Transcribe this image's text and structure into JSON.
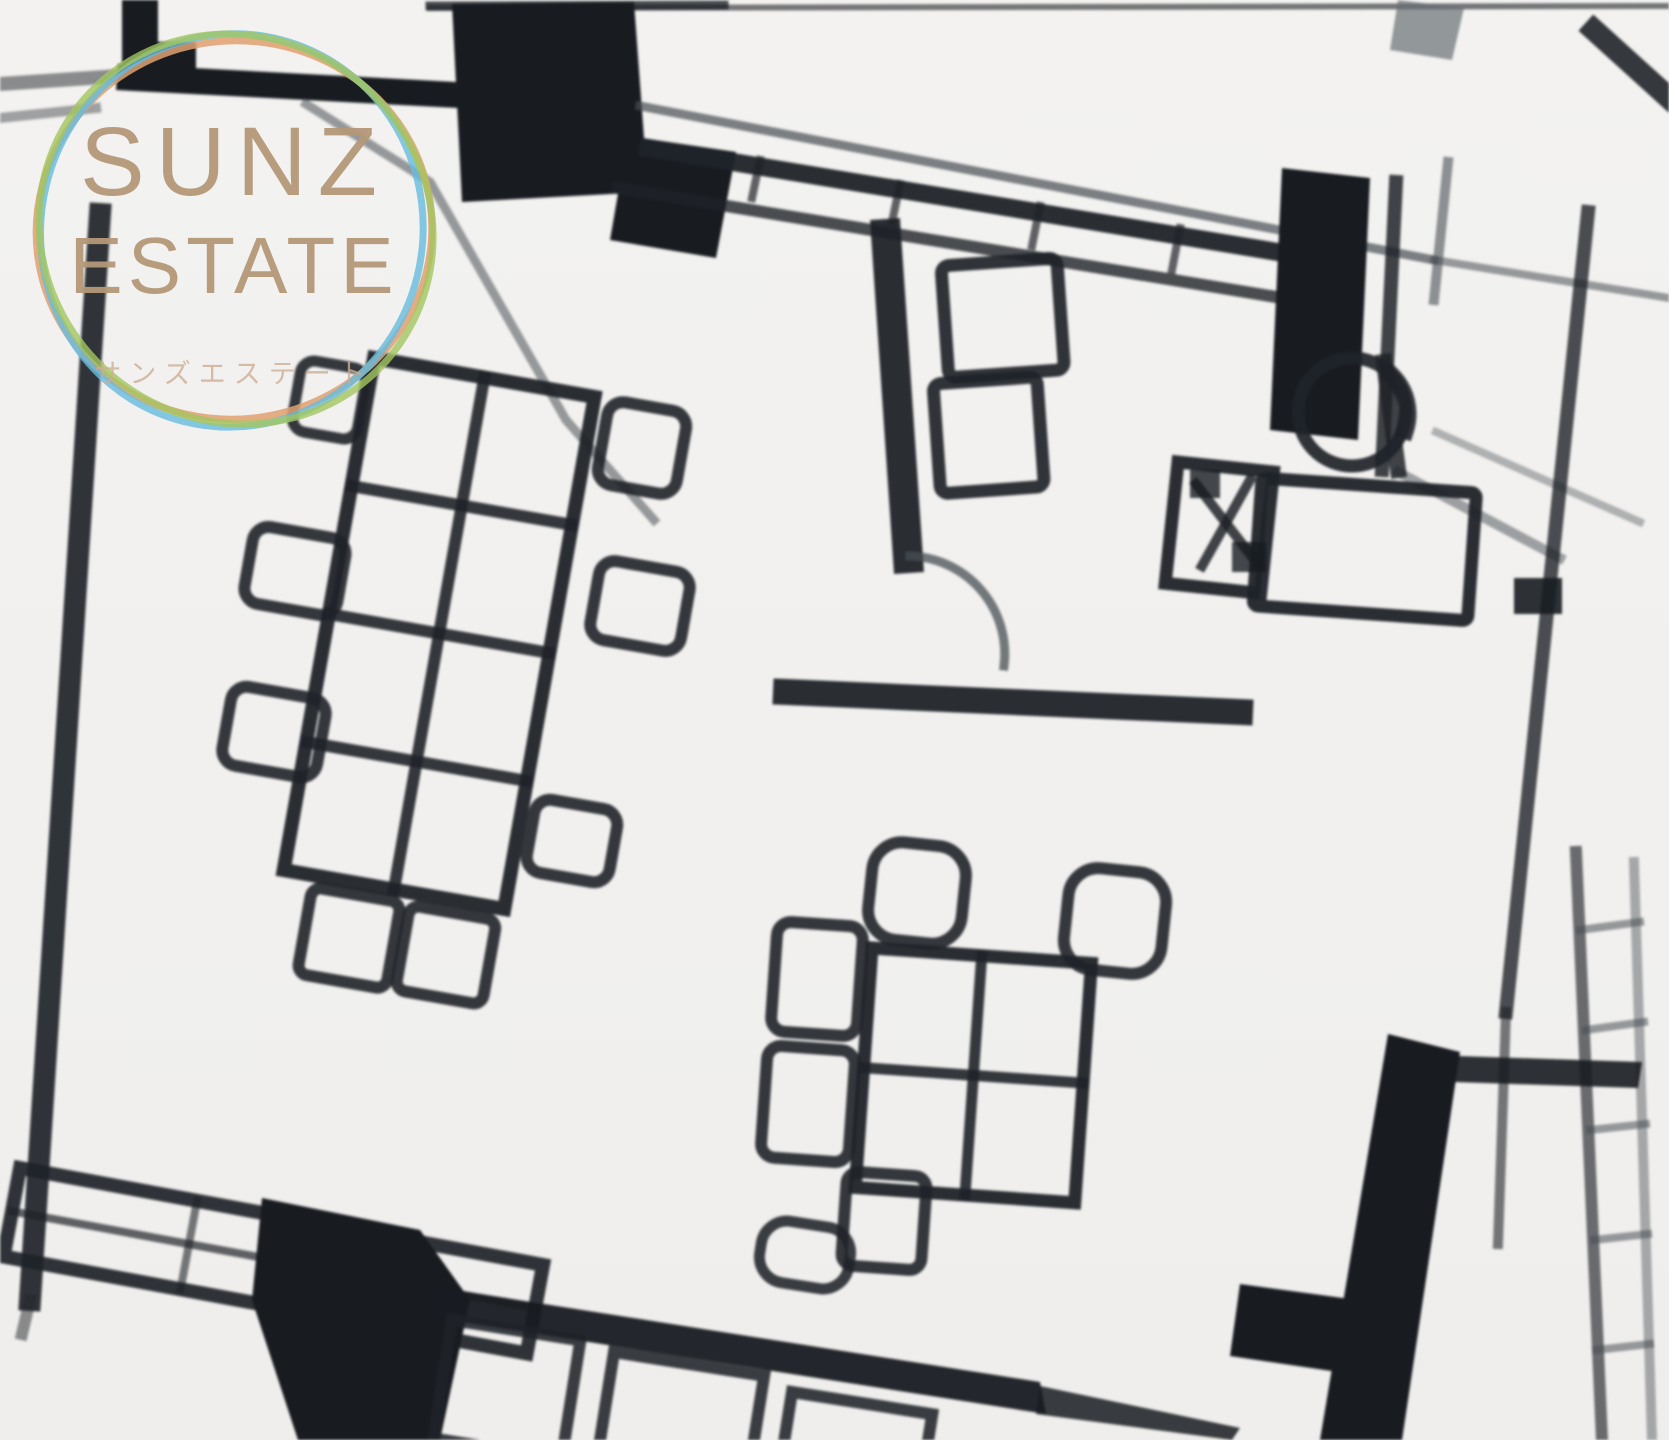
{
  "watermark": {
    "line1": "SUNZ",
    "line2": "ESTATE",
    "subtitle": "サンズエステート",
    "text_color": "#b49878",
    "subtitle_color": "#ccae94",
    "ring_colors": {
      "orange": "#e0a070",
      "blue": "#66bcdf",
      "green": "#a3c55f"
    }
  },
  "floor_plan": {
    "style": "black-and-white architectural floor plan, heavily pixelated low-resolution enlargement, slightly tilted",
    "ink_color": "#23272c",
    "background_color": "#f2f1ee",
    "elements": [
      "meeting-table-8-seats",
      "dining-chairs",
      "sofa-2-seat",
      "reception-desk",
      "round-desk-chair",
      "office-equipment-box",
      "door-swing-arc",
      "black-wall-pillars",
      "kitchen-counter",
      "bottom-table-row",
      "thick-corner-wall",
      "hatched-exterior-wall"
    ]
  }
}
